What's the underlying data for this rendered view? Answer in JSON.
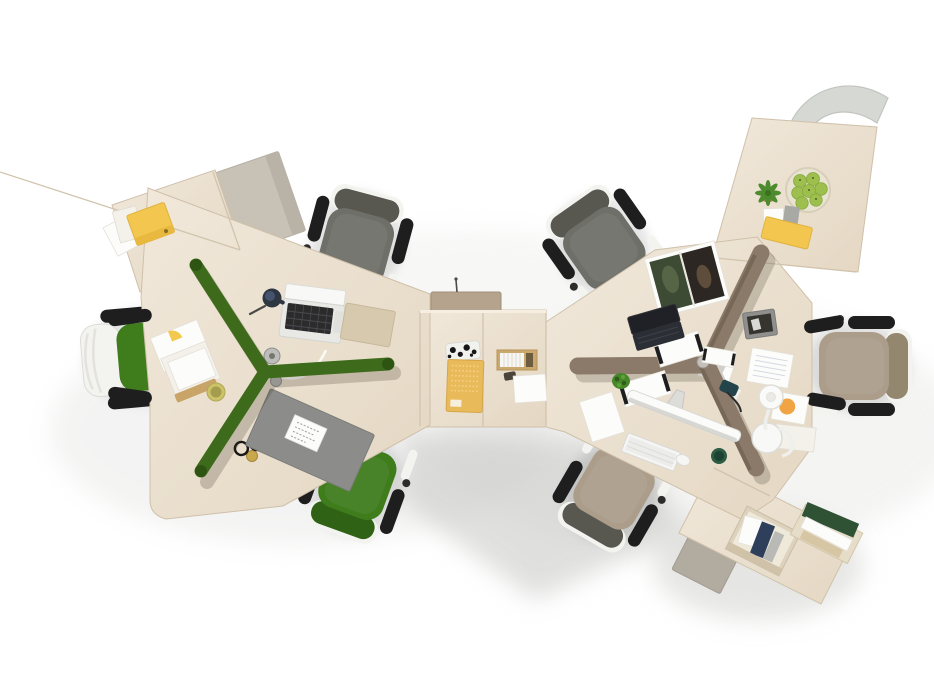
{
  "scene": {
    "description": "Top-down product photograph of a modular office workstation system: two Y-shaped three-seat desk clusters in pale ash wood joined by a square center module. The left cluster has a dark green Y-shaped fabric divider, the right cluster a taupe Y-shaped divider. Seven task chairs (gray, green and taupe upholstery, white frames, black armrests) surround the desks. Desk accessories include an open silver laptop, a black laptop, an iMac-style monitor with keyboard and mouse, an open magazine, notebooks, papers, desk pads, a desk lamp, a bowl of green apples, succulent plants, yellow file boxes and wooden file organizers. White seamless background with soft floor shadows.",
    "setting": "studio photo, bird's-eye view",
    "counts": {
      "desk_clusters": 2,
      "chairs": 7,
      "dividers": 2
    },
    "objects": [
      "left-desk-cluster",
      "right-desk-cluster",
      "center-desk-module",
      "green-y-divider",
      "taupe-y-divider",
      "gray-office-chair-left-top",
      "white-green-office-chair-left",
      "green-office-chair-left-bottom",
      "gray-office-chair-right-top",
      "taupe-office-chair-right",
      "taupe-office-chair-right-bottom",
      "white-visitor-chair-top-right",
      "silver-laptop",
      "black-laptop",
      "imac-monitor",
      "white-keyboard",
      "white-mouse",
      "open-magazine",
      "yellow-notebook",
      "patterned-pouch",
      "wooden-card-box",
      "white-notepads",
      "gray-desk-pad",
      "white-card",
      "eyeglasses",
      "brass-cup",
      "olive-cup",
      "navy-mug",
      "green-cup",
      "desk-lamp",
      "orange-dot-card",
      "ruled-paper",
      "photo-frame",
      "apple-bowl",
      "succulent-plant",
      "small-plant",
      "yellow-file-box-left",
      "yellow-file-box-right",
      "file-organizers",
      "gray-cabinets",
      "cable-grommets",
      "white-cable"
    ]
  },
  "colors": {
    "background": "#ffffff",
    "wood": "#ebe1d1",
    "wood_light": "#f2e9dc",
    "wood_dark": "#e2d5c2",
    "wood_seam": "#d2c3ad",
    "wood_edge": "#cfc0aa",
    "divider_green": "#3e6b1b",
    "divider_green_dark": "#2e5413",
    "divider_taupe": "#8b7a69",
    "divider_taupe_dark": "#6c5d4e",
    "chair_gray": "#6f6f69",
    "chair_gray_dark": "#585851",
    "chair_green": "#3e7c1c",
    "chair_green_dark": "#2f6214",
    "chair_taupe": "#ab9d8a",
    "chair_taupe_dark": "#948770",
    "chair_frame": "#f3f3f0",
    "armrest": "#1e1e1e",
    "cabinet_gray": "#c8c2b6",
    "cabinet_gray_dark": "#b1aba0",
    "pad_gray": "#8c8c8a",
    "file_yellow": "#f2c64f",
    "notebook_yellow": "#e9ba5a",
    "apple_green": "#9dbf4d",
    "bowl_cream": "#e9e3d1",
    "plant_green": "#47872a",
    "pot_terracotta": "#b07a5a",
    "lamp_white": "#fafaf8",
    "orange_accent": "#f1a443",
    "mug_navy": "#2e3642",
    "cup_olive": "#ccc26a",
    "cup_green": "#2d5c45",
    "brass": "#c9a84c",
    "paper_white": "#fcfcfa",
    "paper_off": "#f3f1ea",
    "folder_blue": "#2e3f5c",
    "folder_green": "#2e5233",
    "folio_tan": "#d7c9ae",
    "laptop_silver": "#e8e8e5",
    "laptop_key": "#2b2b2b",
    "laptop_black": "#26272c",
    "magazine_left": "#3e4b34",
    "magazine_right": "#2c2722",
    "frame_gray": "#8f8f8d",
    "white_chair": "#d6d9d3"
  }
}
